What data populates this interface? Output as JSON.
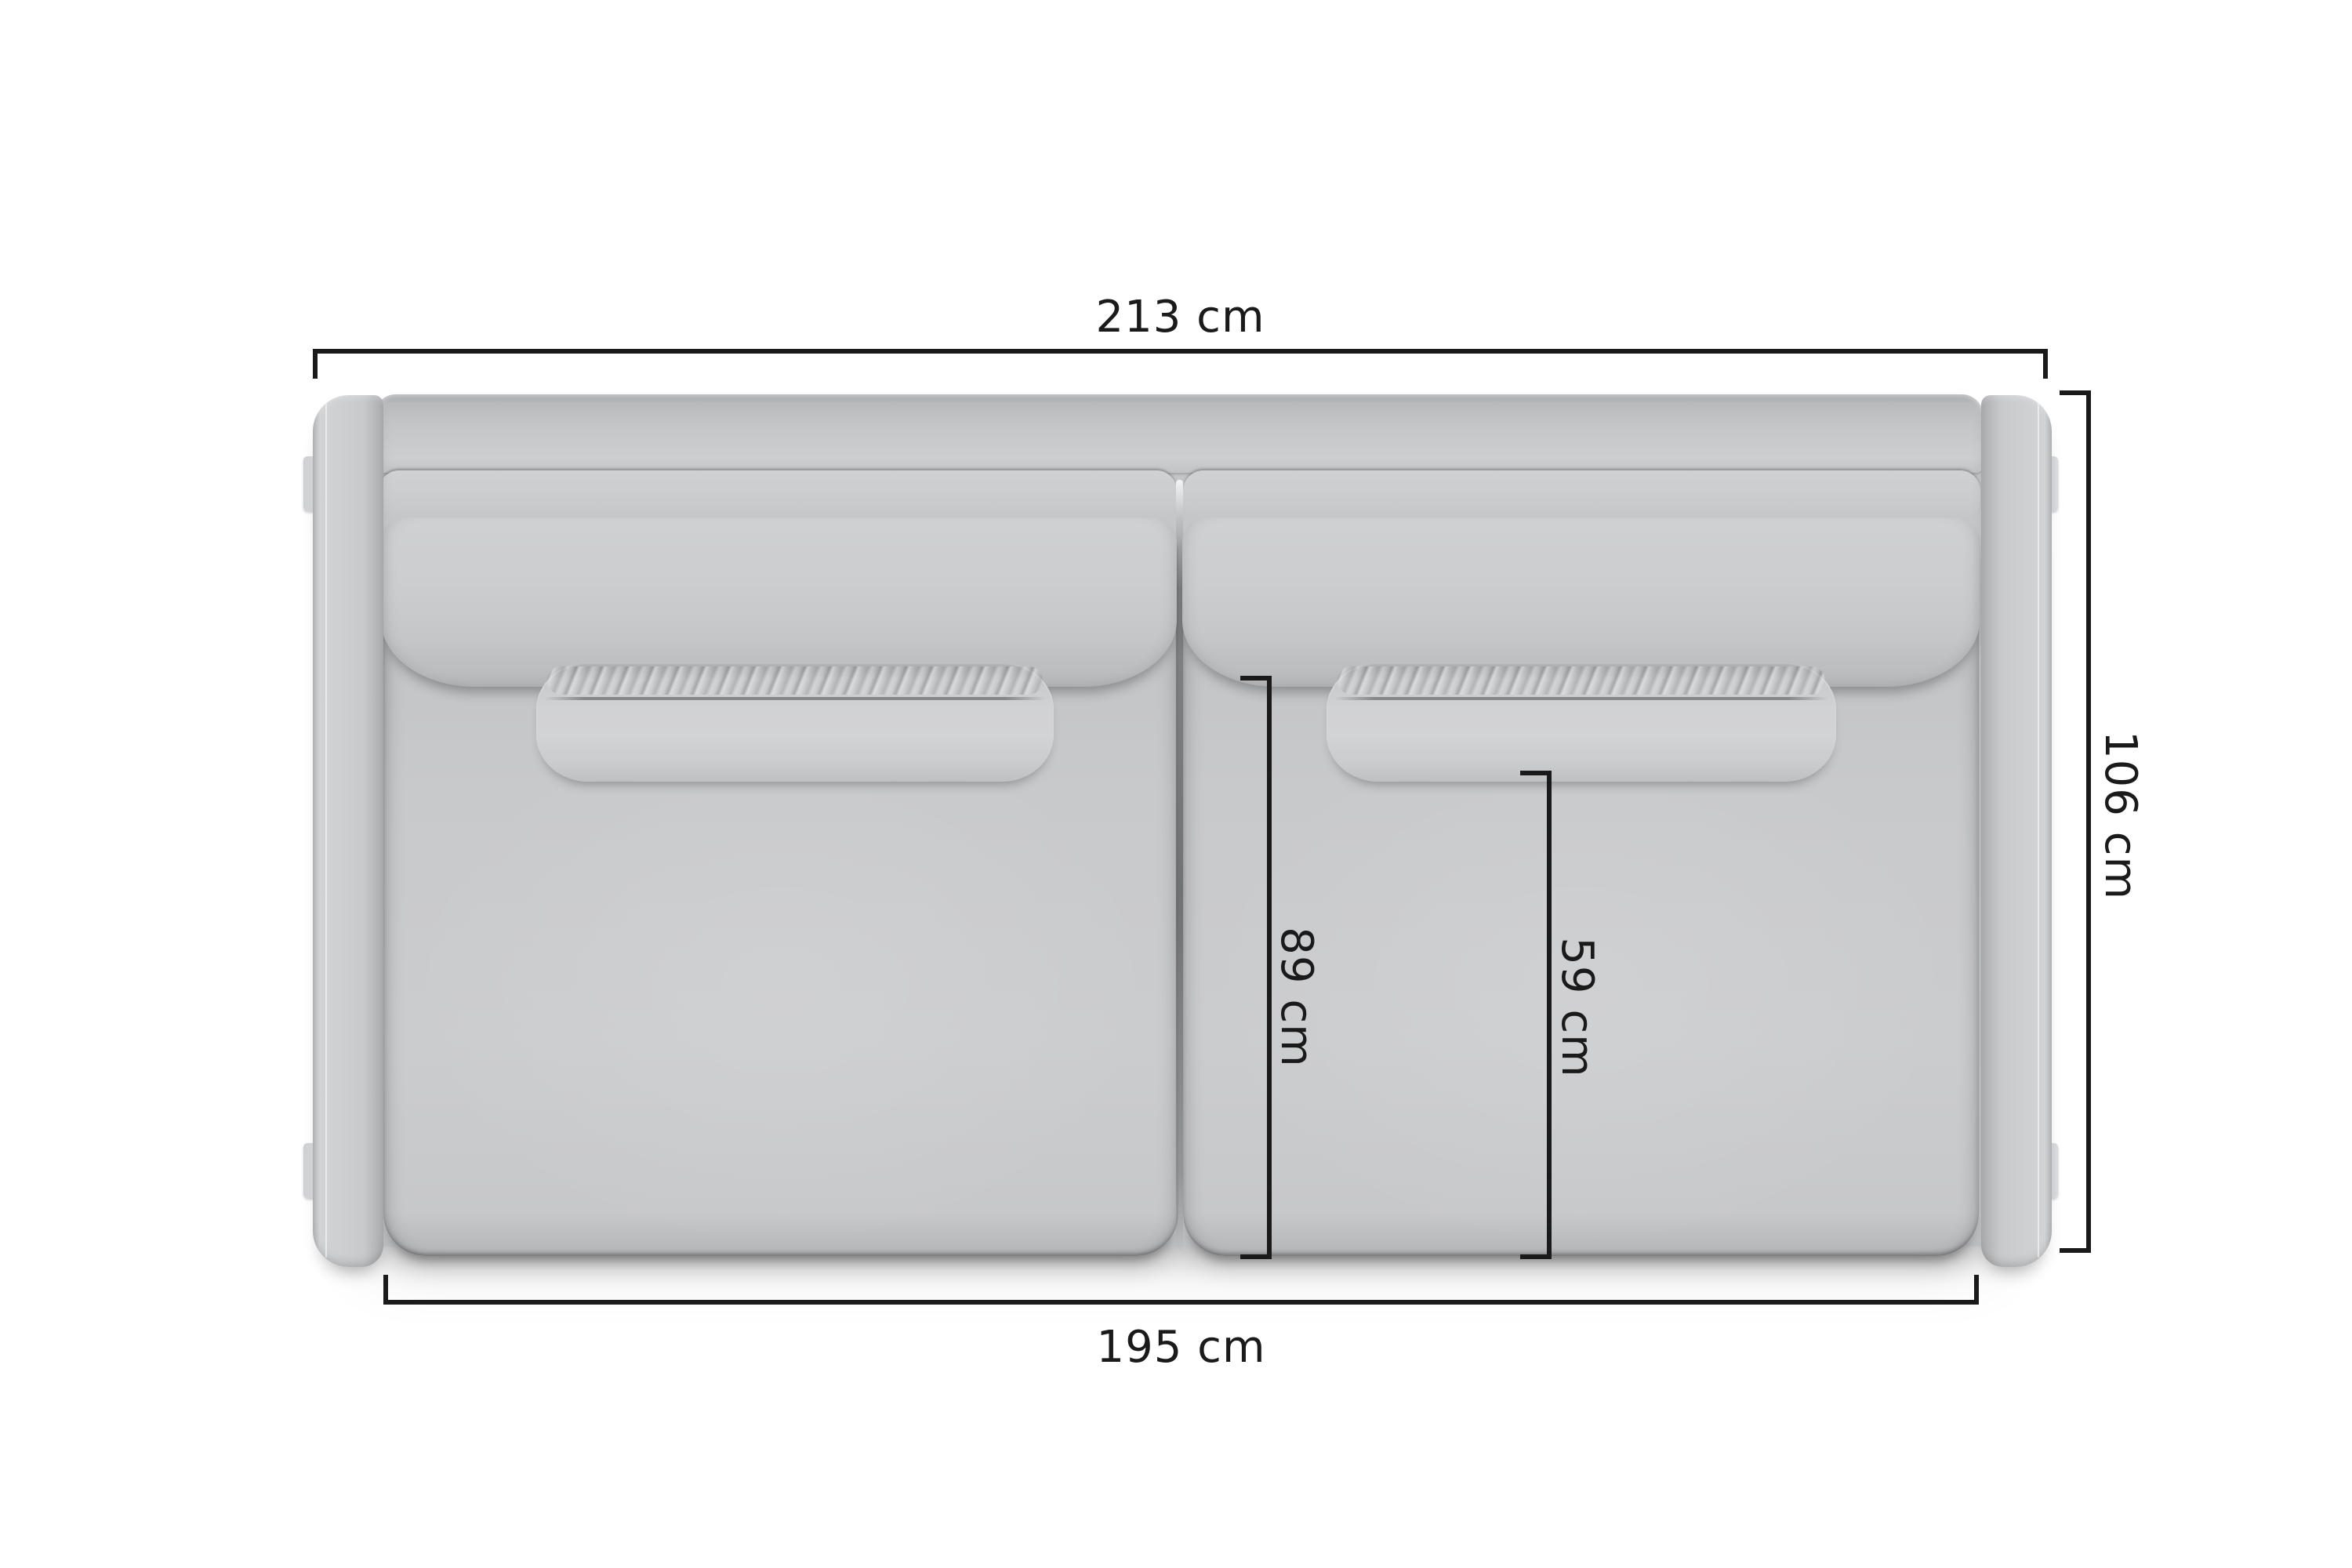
{
  "diagram": {
    "type": "furniture-dimension-top-view",
    "subject": "Two-seat sofa, top view dimension drawing",
    "background_color": "#ffffff",
    "line_color": "#1a1a1a",
    "sofa_color": "#c9cacc",
    "dimensions": {
      "overall_width": {
        "label": "213 cm",
        "value": 213,
        "unit": "cm",
        "edge": "top",
        "orientation": "horizontal"
      },
      "overall_depth": {
        "label": "106 cm",
        "value": 106,
        "unit": "cm",
        "edge": "right",
        "orientation": "vertical"
      },
      "seat_depth": {
        "label": "89 cm",
        "value": 89,
        "unit": "cm",
        "edge": "inner-left",
        "orientation": "vertical"
      },
      "pillow_to_front": {
        "label": "59 cm",
        "value": 59,
        "unit": "cm",
        "edge": "inner-right",
        "orientation": "vertical"
      },
      "inner_width": {
        "label": "195 cm",
        "value": 195,
        "unit": "cm",
        "edge": "bottom",
        "orientation": "horizontal"
      }
    }
  }
}
